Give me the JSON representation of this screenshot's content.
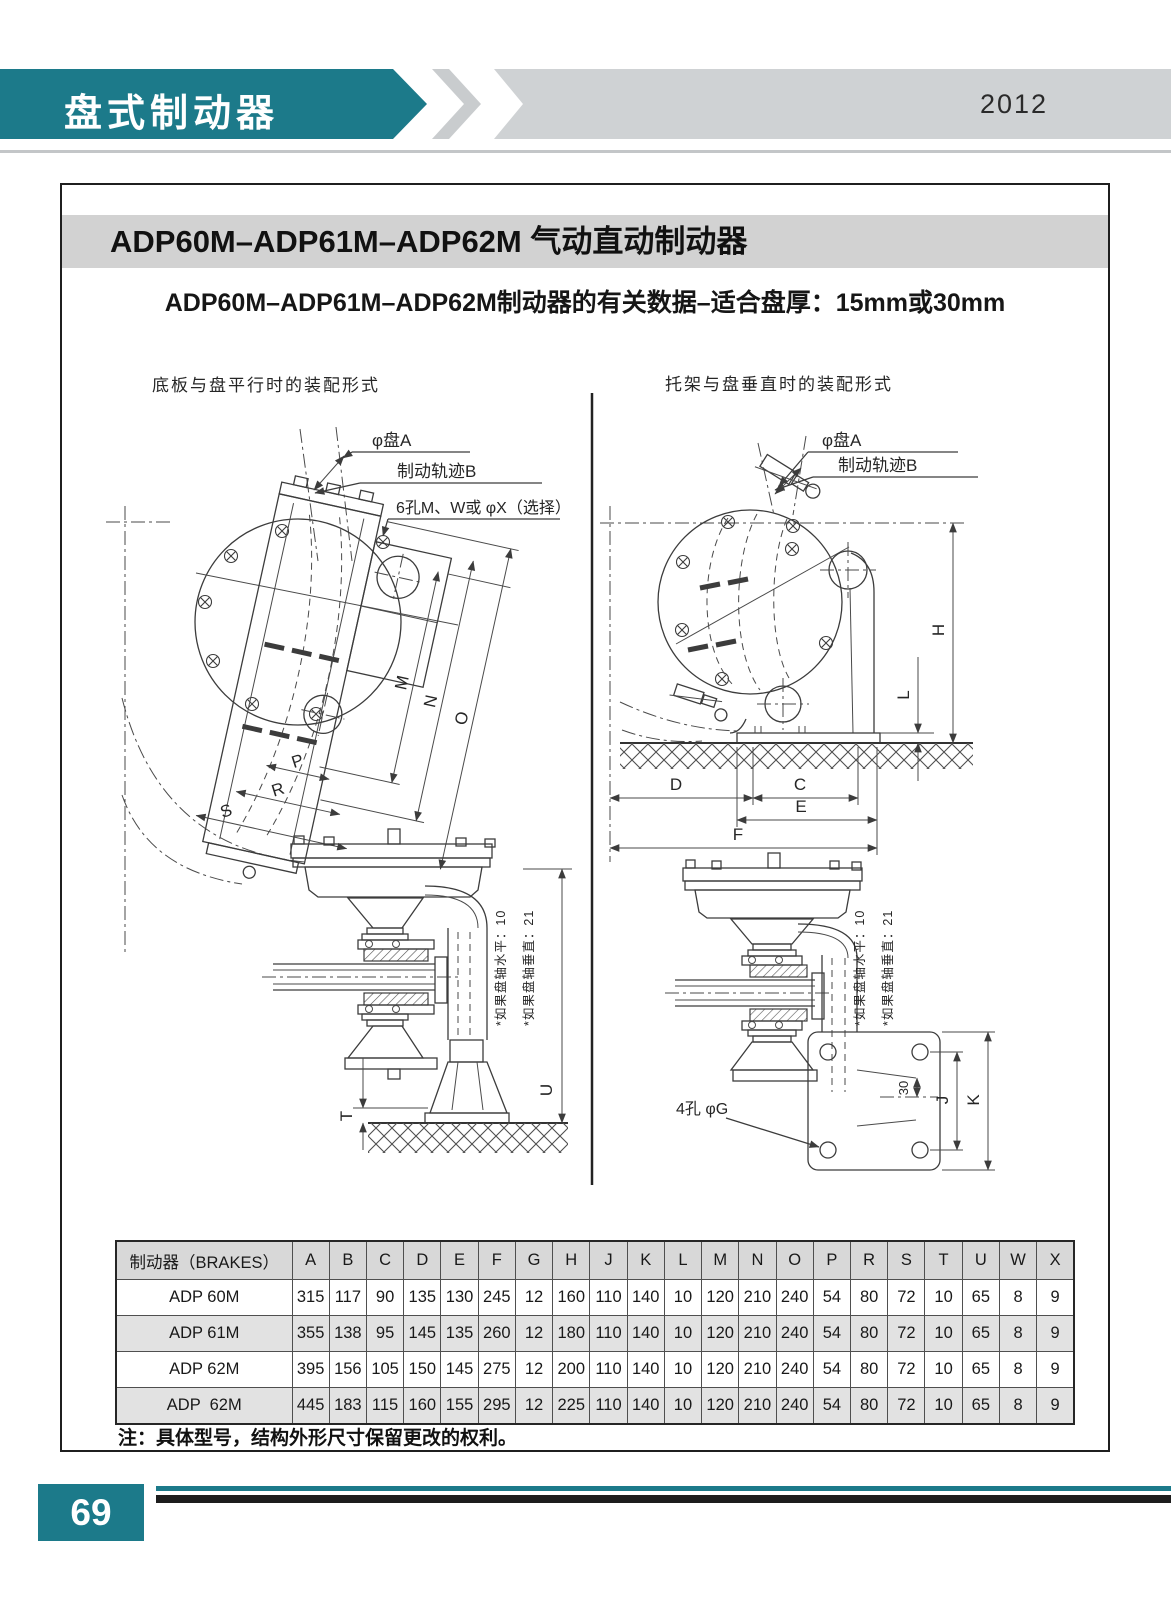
{
  "page": {
    "category": "盘式制动器",
    "year": "2012",
    "page_number": "69"
  },
  "content": {
    "title": "ADP60M–ADP61M–ADP62M 气动直动制动器",
    "subtitle": "ADP60M–ADP61M–ADP62M制动器的有关数据–适合盘厚：15mm或30mm",
    "note": "注：具体型号，结构外形尺寸保留更改的权利。"
  },
  "diagrams": {
    "left": {
      "title": "底板与盘平行时的装配形式",
      "callouts": [
        "φ盘A",
        "制动轨迹B",
        "6孔M、W或 φX（选择）"
      ],
      "dims": [
        "M",
        "N",
        "O",
        "P",
        "R",
        "S",
        "T",
        "U"
      ],
      "notes": [
        "*如果盘轴水平：10",
        "*如果盘轴垂直：21"
      ]
    },
    "right": {
      "title": "托架与盘垂直时的装配形式",
      "callouts": [
        "φ盘A",
        "制动轨迹B",
        "4孔 φG"
      ],
      "dims": [
        "H",
        "L",
        "D",
        "C",
        "E",
        "F",
        "30",
        "J",
        "K"
      ],
      "notes": [
        "*如果盘轴水平：10",
        "*如果盘轴垂直：21"
      ]
    }
  },
  "table": {
    "header_label": "制动器（BRAKES）",
    "columns": [
      "A",
      "B",
      "C",
      "D",
      "E",
      "F",
      "G",
      "H",
      "J",
      "K",
      "L",
      "M",
      "N",
      "O",
      "P",
      "R",
      "S",
      "T",
      "U",
      "W",
      "X"
    ],
    "rows": [
      {
        "model": "ADP 60M",
        "values": [
          315,
          117,
          90,
          135,
          130,
          245,
          12,
          160,
          110,
          140,
          10,
          120,
          210,
          240,
          54,
          80,
          72,
          10,
          65,
          8,
          9
        ]
      },
      {
        "model": "ADP 61M",
        "values": [
          355,
          138,
          95,
          145,
          135,
          260,
          12,
          180,
          110,
          140,
          10,
          120,
          210,
          240,
          54,
          80,
          72,
          10,
          65,
          8,
          9
        ]
      },
      {
        "model": "ADP 62M",
        "values": [
          395,
          156,
          105,
          150,
          145,
          275,
          12,
          200,
          110,
          140,
          10,
          120,
          210,
          240,
          54,
          80,
          72,
          10,
          65,
          8,
          9
        ]
      },
      {
        "model": "ADP  62M",
        "values": [
          445,
          183,
          115,
          160,
          155,
          295,
          12,
          225,
          110,
          140,
          10,
          120,
          210,
          240,
          54,
          80,
          72,
          10,
          65,
          8,
          9
        ]
      }
    ]
  },
  "colors": {
    "teal": "#1c7a8a",
    "banner_gray": "#cfd2d4",
    "chevron_gray": "#c9ccce",
    "title_bg": "#d2d2d2",
    "table_header_bg": "#d8d8d8",
    "row_alt": "#e2e2e2",
    "line": "#3c3c3c"
  }
}
